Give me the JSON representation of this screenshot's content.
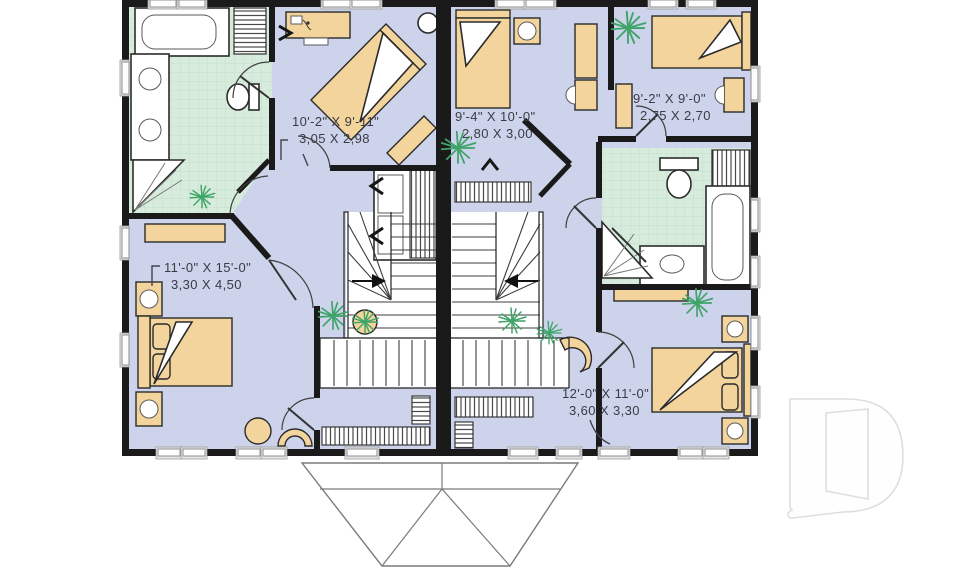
{
  "labels": {
    "bedroom_top_left": {
      "imperial": "10'-2\" X 9'-11\"",
      "metric": "3,05 X 2,98"
    },
    "bedroom_top_center": {
      "imperial": "9'-4\" X 10'-0\"",
      "metric": "2,80 X 3,00"
    },
    "bedroom_top_right": {
      "imperial": "9'-2\" X 9'-0\"",
      "metric": "2,75 X 2,70"
    },
    "bedroom_bottom_left": {
      "imperial": "11'-0\" X 15'-0\"",
      "metric": "3,30 X 4,50"
    },
    "bedroom_bottom_right": {
      "imperial": "12'-0\" X 11'-0\"",
      "metric": "3,60 X 3,30"
    }
  },
  "watermark": {
    "letter": "D"
  },
  "colors": {
    "wall": "#1a1a1a",
    "bedroom_floor": "#ccd3ea",
    "bathroom_tile": "#d8ecdd",
    "tile_grid": "#c2dfc9",
    "furniture": "#f2d49c",
    "plant": "#3fa468",
    "window": "#fdfdfd",
    "label_text": "#3a3b45",
    "watermark_stroke": "#dedede"
  },
  "icons": {
    "plant_icon": "green starburst of radiating lines",
    "potted_plant_icon": "tan circle pot with green fronds",
    "stair_direction_icon": "black arrow with tail",
    "watermark_d_icon": "pale outline letter D with open door"
  }
}
